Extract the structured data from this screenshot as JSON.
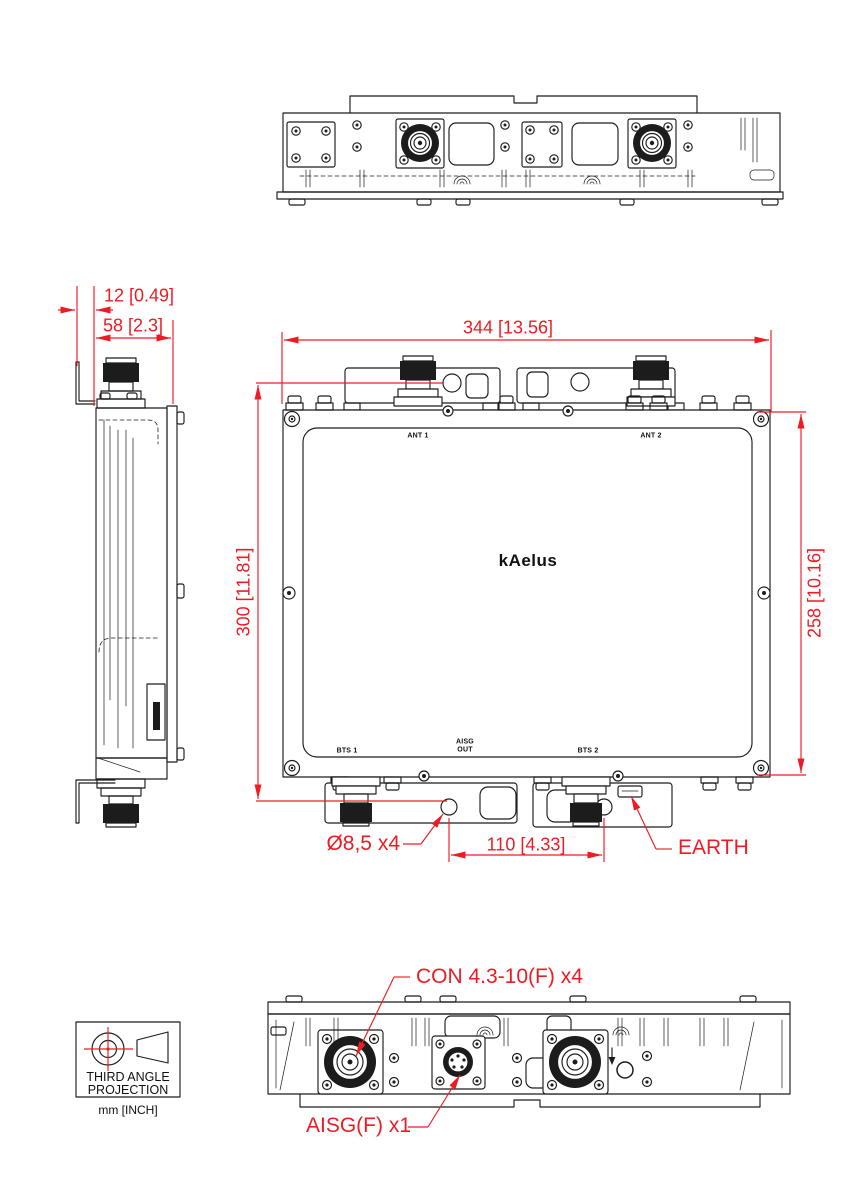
{
  "drawing": {
    "brand": "kAelus",
    "units_note": "mm [INCH]",
    "projection_note": {
      "line1": "THIRD ANGLE",
      "line2": "PROJECTION"
    },
    "colors": {
      "dimension_red": "#ed1c24",
      "line_black": "#1c1c1c"
    },
    "dimensions": {
      "overall_width": "344 [13.56]",
      "mounting_height": "300 [11.81]",
      "body_height": "258 [10.16]",
      "body_depth": "58 [2.3]",
      "bracket_offset": "12 [0.49]",
      "bottom_hole_spacing": "110 [4.33]",
      "mounting_hole": "Ø8,5 x4"
    },
    "callouts": {
      "earth": "EARTH",
      "rf_connectors": "CON 4.3-10(F) x4",
      "aisg_connector": "AISG(F) x1"
    },
    "ports": {
      "ant1": "ANT 1",
      "ant2": "ANT 2",
      "bts1": "BTS 1",
      "bts2": "BTS 2",
      "aisg_out_line1": "AISG",
      "aisg_out_line2": "OUT"
    }
  }
}
